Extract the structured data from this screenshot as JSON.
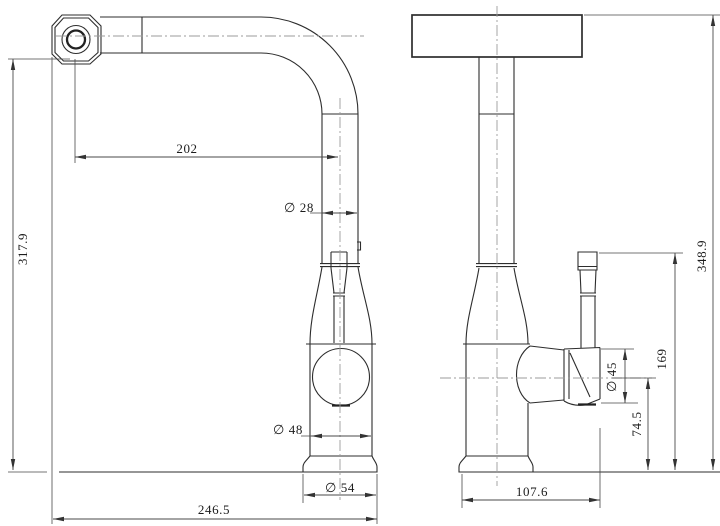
{
  "drawing": {
    "dimension_labels": {
      "spout_reach": "202",
      "spout_tube_diameter": "∅ 28",
      "spout_outlet_height": "317.9",
      "body_diameter": "∅ 48",
      "base_diameter": "∅ 54",
      "overall_projection": "246.5",
      "overall_height": "348.9",
      "handle_hub_diameter": "∅ 45",
      "handle_center_height": "74.5",
      "handle_top_height": "169",
      "body_handle_depth": "107.6"
    }
  }
}
